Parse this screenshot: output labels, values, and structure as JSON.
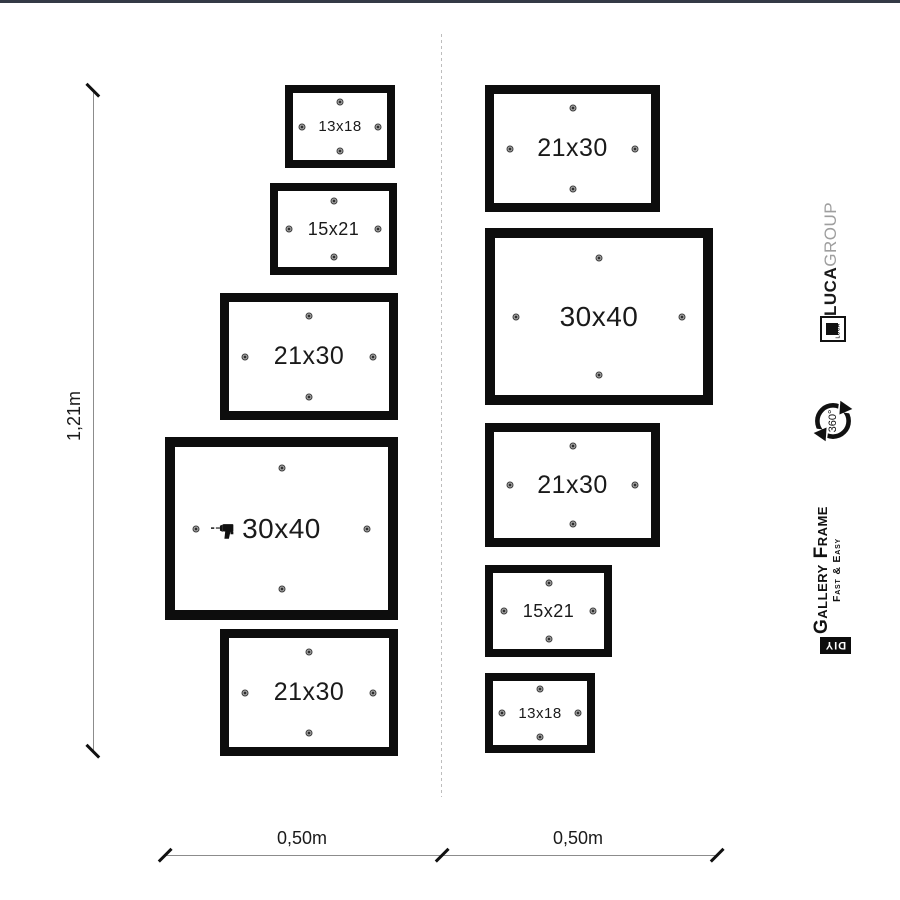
{
  "diagram": {
    "type": "gallery-wall-hanging-template",
    "wall_height_label": "1,21m",
    "wall_width_left_label": "0,50m",
    "wall_width_right_label": "0,50m",
    "frames": [
      {
        "label": "13x18",
        "x": 285,
        "y": 85,
        "w": 110,
        "h": 83,
        "border": 8,
        "font": 15,
        "drill": false
      },
      {
        "label": "15x21",
        "x": 270,
        "y": 183,
        "w": 127,
        "h": 92,
        "border": 8,
        "font": 18,
        "drill": false
      },
      {
        "label": "21x30",
        "x": 220,
        "y": 293,
        "w": 178,
        "h": 127,
        "border": 9,
        "font": 25,
        "drill": false
      },
      {
        "label": "30x40",
        "x": 165,
        "y": 437,
        "w": 233,
        "h": 183,
        "border": 10,
        "font": 28,
        "drill": true
      },
      {
        "label": "21x30",
        "x": 220,
        "y": 629,
        "w": 178,
        "h": 127,
        "border": 9,
        "font": 25,
        "drill": false
      },
      {
        "label": "21x30",
        "x": 485,
        "y": 85,
        "w": 175,
        "h": 127,
        "border": 9,
        "font": 25,
        "drill": false
      },
      {
        "label": "30x40",
        "x": 485,
        "y": 228,
        "w": 228,
        "h": 177,
        "border": 10,
        "font": 28,
        "drill": false
      },
      {
        "label": "21x30",
        "x": 485,
        "y": 423,
        "w": 175,
        "h": 124,
        "border": 9,
        "font": 25,
        "drill": false
      },
      {
        "label": "15x21",
        "x": 485,
        "y": 565,
        "w": 127,
        "h": 92,
        "border": 8,
        "font": 18,
        "drill": false
      },
      {
        "label": "13x18",
        "x": 485,
        "y": 673,
        "w": 110,
        "h": 80,
        "border": 8,
        "font": 15,
        "drill": false
      }
    ]
  },
  "branding": {
    "luca": "LUCA",
    "group": "GROUP",
    "logo_text": "LUCA",
    "rotation": "360°",
    "product": "Gallery Frame",
    "tagline": "Fast & Easy",
    "diy": "DIY"
  },
  "colors": {
    "frame_black": "#0d0d0d",
    "dimension_gray": "#8c8c8c",
    "dash_gray": "#bdbdbd",
    "group_gray": "#9e9e9e",
    "topbar": "#343a46"
  }
}
